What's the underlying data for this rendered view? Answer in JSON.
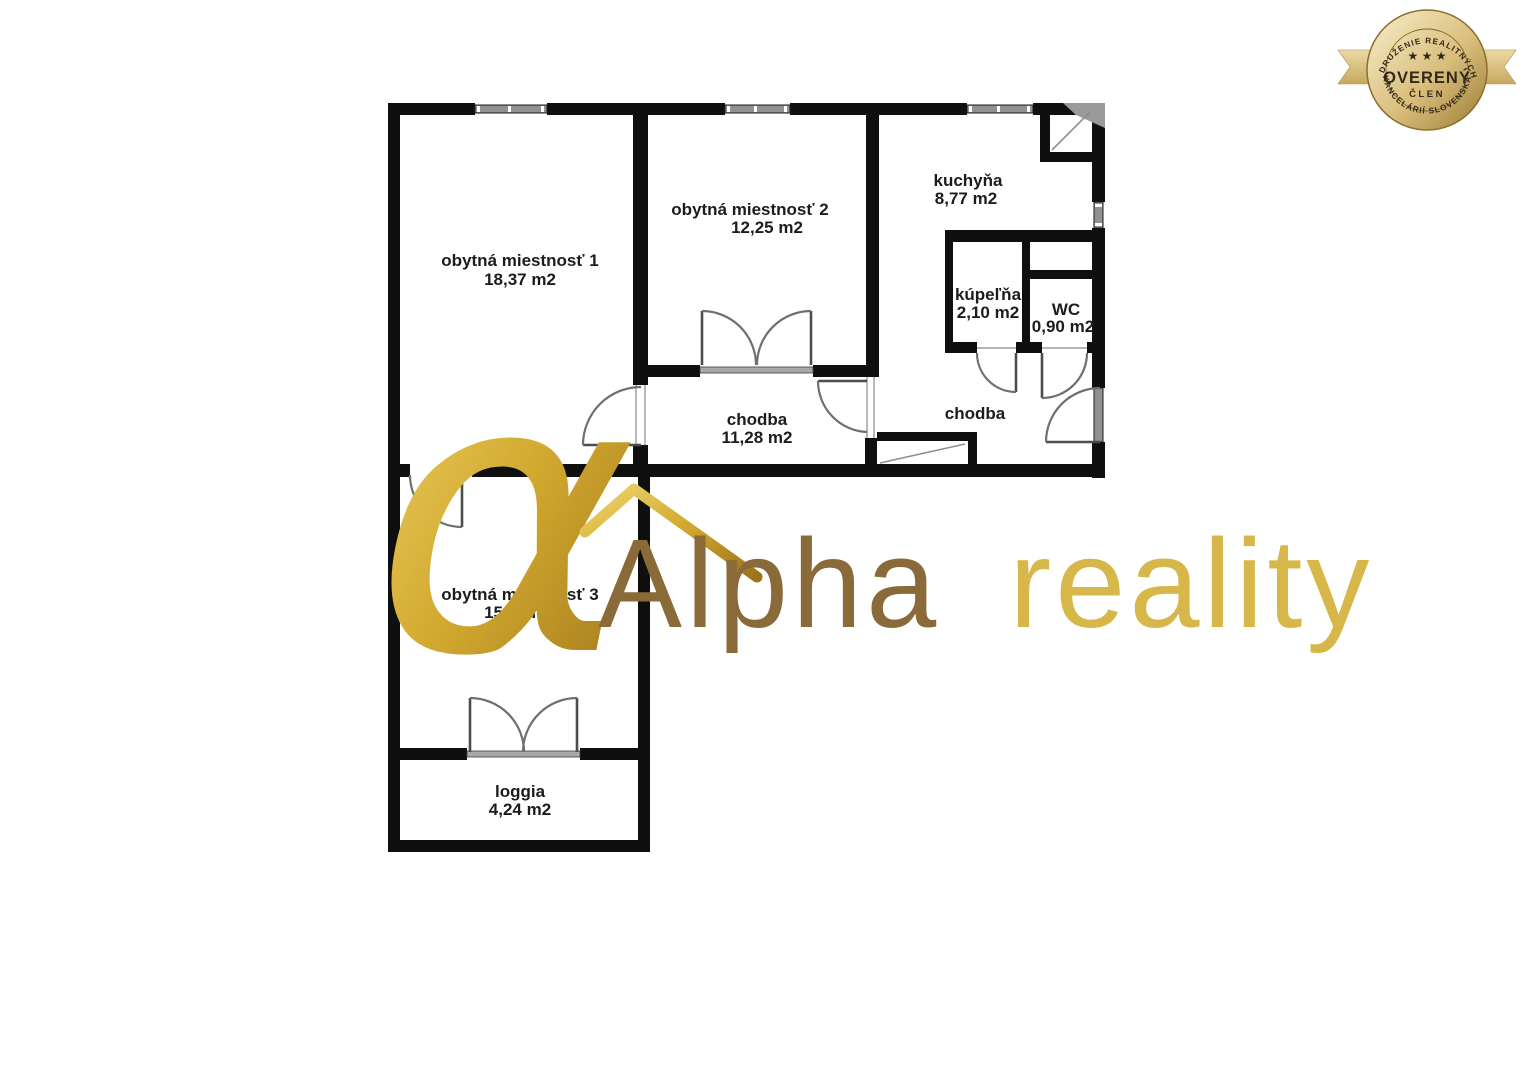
{
  "page": {
    "background": "#ffffff"
  },
  "floorplan": {
    "wall_color": "#0f0f0f",
    "door_color": "#6f6f6f",
    "window_color": "#919191",
    "label_color": "#1c1c1c",
    "rooms": {
      "room1": {
        "name": "obytná miestnosť 1",
        "area": "18,37 m2"
      },
      "room2": {
        "name": "obytná miestnosť 2",
        "area": "12,25 m2"
      },
      "kitchen": {
        "name": "kuchyňa",
        "area": "8,77 m2"
      },
      "bathroom": {
        "name": "kúpeľňa",
        "area": "2,10 m2"
      },
      "wc": {
        "name": "WC",
        "area": "0,90 m2"
      },
      "hall_main": {
        "name": "chodba",
        "area": "11,28 m2"
      },
      "hall_entry": {
        "name": "chodba"
      },
      "room3": {
        "name": "obytná miestnosť 3",
        "area": "15,05 m2"
      },
      "loggia": {
        "name": "loggia",
        "area": "4,24 m2"
      }
    }
  },
  "watermark": {
    "alpha_glyph": "α",
    "brand_word1": "Alpha",
    "brand_word2": "reality",
    "gold_light": "#f0d56d",
    "gold_mid": "#d2a92f",
    "gold_dark": "#9c731b",
    "word1_color": "#8a6a38",
    "word2_color": "#d8b74a"
  },
  "badge": {
    "arc_top": "ZDRUŽENIE REALITNÝCH",
    "stars": "★ ★ ★",
    "title": "OVERENÝ",
    "subtitle": "ČLEN",
    "arc_bottom": "KANCELÁRIÍ SLOVENSKA",
    "gold_light": "#f8efcd",
    "gold_mid": "#d9be7c",
    "gold_dark": "#9a7b33",
    "ribbon_light": "#ecd9a4",
    "ribbon_dark": "#c6a85e",
    "text_color": "#33291a"
  }
}
